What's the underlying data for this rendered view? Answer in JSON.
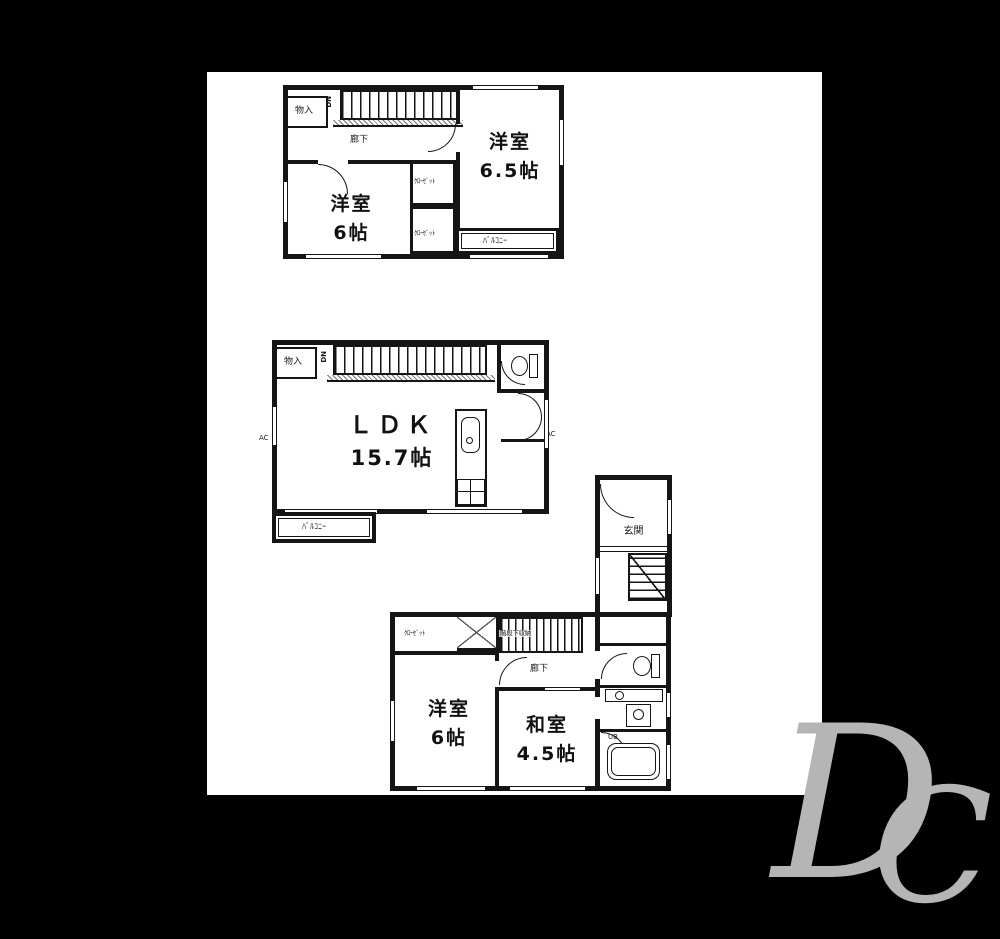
{
  "colors": {
    "ink": "#151515",
    "paper": "#ffffff",
    "canvas": "#000000",
    "watermark": "#b5b5b5"
  },
  "watermark": {
    "letter_d": "D",
    "letter_c": "C"
  },
  "plan_top": {
    "room_a": {
      "name": "洋室",
      "size": "6.5帖"
    },
    "room_b": {
      "name": "洋室",
      "size": "6帖"
    },
    "storage": "物入",
    "hallway": "廊下",
    "closet_a": "ｸﾛｰｾﾞｯﾄ",
    "closet_b": "ｸﾛｰｾﾞｯﾄ",
    "balcony": "ﾊﾞﾙｺﾆｰ",
    "stairs_dn": "DN"
  },
  "plan_middle": {
    "room": {
      "name": "ＬＤＫ",
      "size": "15.7帖"
    },
    "storage": "物入",
    "balcony": "ﾊﾞﾙｺﾆｰ",
    "stairs_dn": "DN",
    "ac_left": "AC",
    "ac_right": "AC"
  },
  "plan_bottom": {
    "entrance": "玄関",
    "hallway": "廊下",
    "closet": "ｸﾛｰｾﾞｯﾄ",
    "under_stairs": "階段下収納",
    "room_a": {
      "name": "洋室",
      "size": "6帖"
    },
    "room_b": {
      "name": "和室",
      "size": "4.5帖"
    },
    "bath": "UB"
  }
}
